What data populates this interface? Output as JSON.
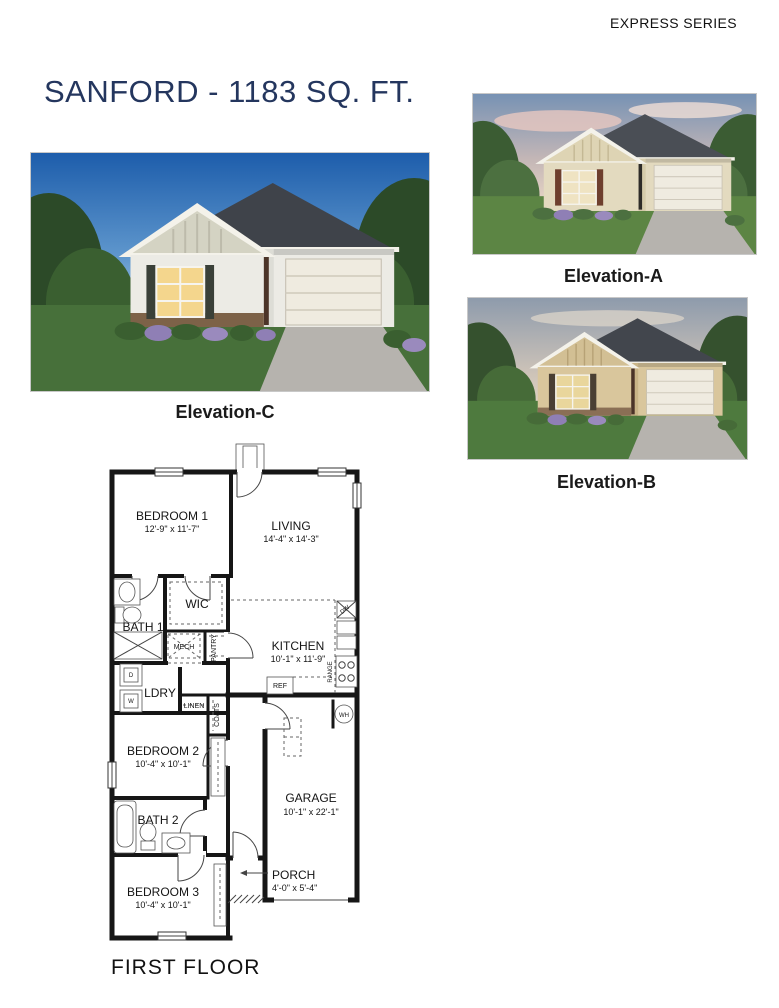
{
  "header": {
    "series_label": "EXPRESS SERIES",
    "title": "SANFORD - 1183 SQ. FT."
  },
  "colors": {
    "title_navy": "#24365e",
    "plan_wall": "#161616"
  },
  "elevations": [
    {
      "id": "C",
      "label": "Elevation-C"
    },
    {
      "id": "A",
      "label": "Elevation-A"
    },
    {
      "id": "B",
      "label": "Elevation-B"
    }
  ],
  "floor_plan": {
    "caption": "FIRST FLOOR",
    "rooms": [
      {
        "name": "BEDROOM 1",
        "dims": "12'-9\" x 11'-7\""
      },
      {
        "name": "LIVING",
        "dims": "14'-4\" x 14'-3\""
      },
      {
        "name": "KITCHEN",
        "dims": "10'-1\" x 11'-9\""
      },
      {
        "name": "BEDROOM 2",
        "dims": "10'-4\" x 10'-1\""
      },
      {
        "name": "GARAGE",
        "dims": "10'-1\" x 22'-1\""
      },
      {
        "name": "BEDROOM 3",
        "dims": "10'-4\" x 10'-1\""
      },
      {
        "name": "PORCH",
        "dims": "4'-0\" x 5'-4\""
      },
      {
        "name": "BATH 1",
        "dims": ""
      },
      {
        "name": "BATH 2",
        "dims": ""
      },
      {
        "name": "LDRY",
        "dims": ""
      },
      {
        "name": "WIC",
        "dims": ""
      }
    ],
    "features": {
      "mech": "MECH",
      "pantry": "PANTRY",
      "linen": "LINEN",
      "coats": "COATS",
      "ref": "REF",
      "range": "RANGE",
      "dw": "DW",
      "wh": "WH",
      "washer": "W",
      "dryer": "D"
    }
  }
}
